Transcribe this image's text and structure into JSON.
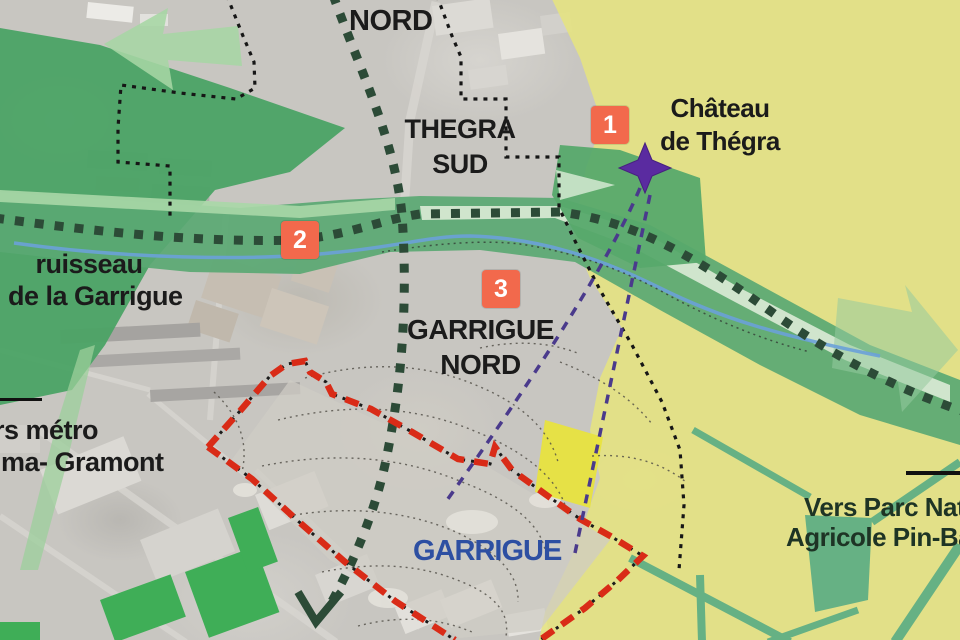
{
  "map": {
    "labels": {
      "nord": "NORD",
      "thegra_sud_line1": "THEGRA",
      "thegra_sud_line2": "SUD",
      "chateau_line1": "Château",
      "chateau_line2": "de Thégra",
      "ruisseau_line1": "ruisseau",
      "ruisseau_line2": "de la Garrigue",
      "metro_line1": "rs métro",
      "metro_line2": "lma- Gramont",
      "garrigue_nord_line1": "GARRIGUE",
      "garrigue_nord_line2": "NORD",
      "garrigue": "GARRIGUE",
      "parc_line1": "Vers Parc Natur",
      "parc_line2": "Agricole Pin-Balm"
    },
    "markers": [
      {
        "label": "1"
      },
      {
        "label": "2"
      },
      {
        "label": "3"
      }
    ],
    "icons": {
      "star": "four-pointed-star",
      "route_arrow": "chevron-arrow-down-left",
      "green_arrow_left": "wide-arrow-up-left",
      "green_arrow_right": "wide-arrow-right"
    },
    "colors": {
      "marker_bg": "#f2694c",
      "marker_text": "#ffffff",
      "red_boundary": "#d92b17",
      "black_boundary": "#161616",
      "route_dotted": "#2c4b37",
      "purple_axis": "#4a3a8c",
      "star": "#5a2ba0",
      "stream": "#6aa1d8",
      "yellow_zone": "#e6e37f",
      "green_dark": "#4ba365",
      "green_mid": "#5aa873",
      "green_light": "#a9d7a7",
      "green_mint": "#d6e8d2",
      "garrigue_text": "#2d4fa2"
    }
  }
}
